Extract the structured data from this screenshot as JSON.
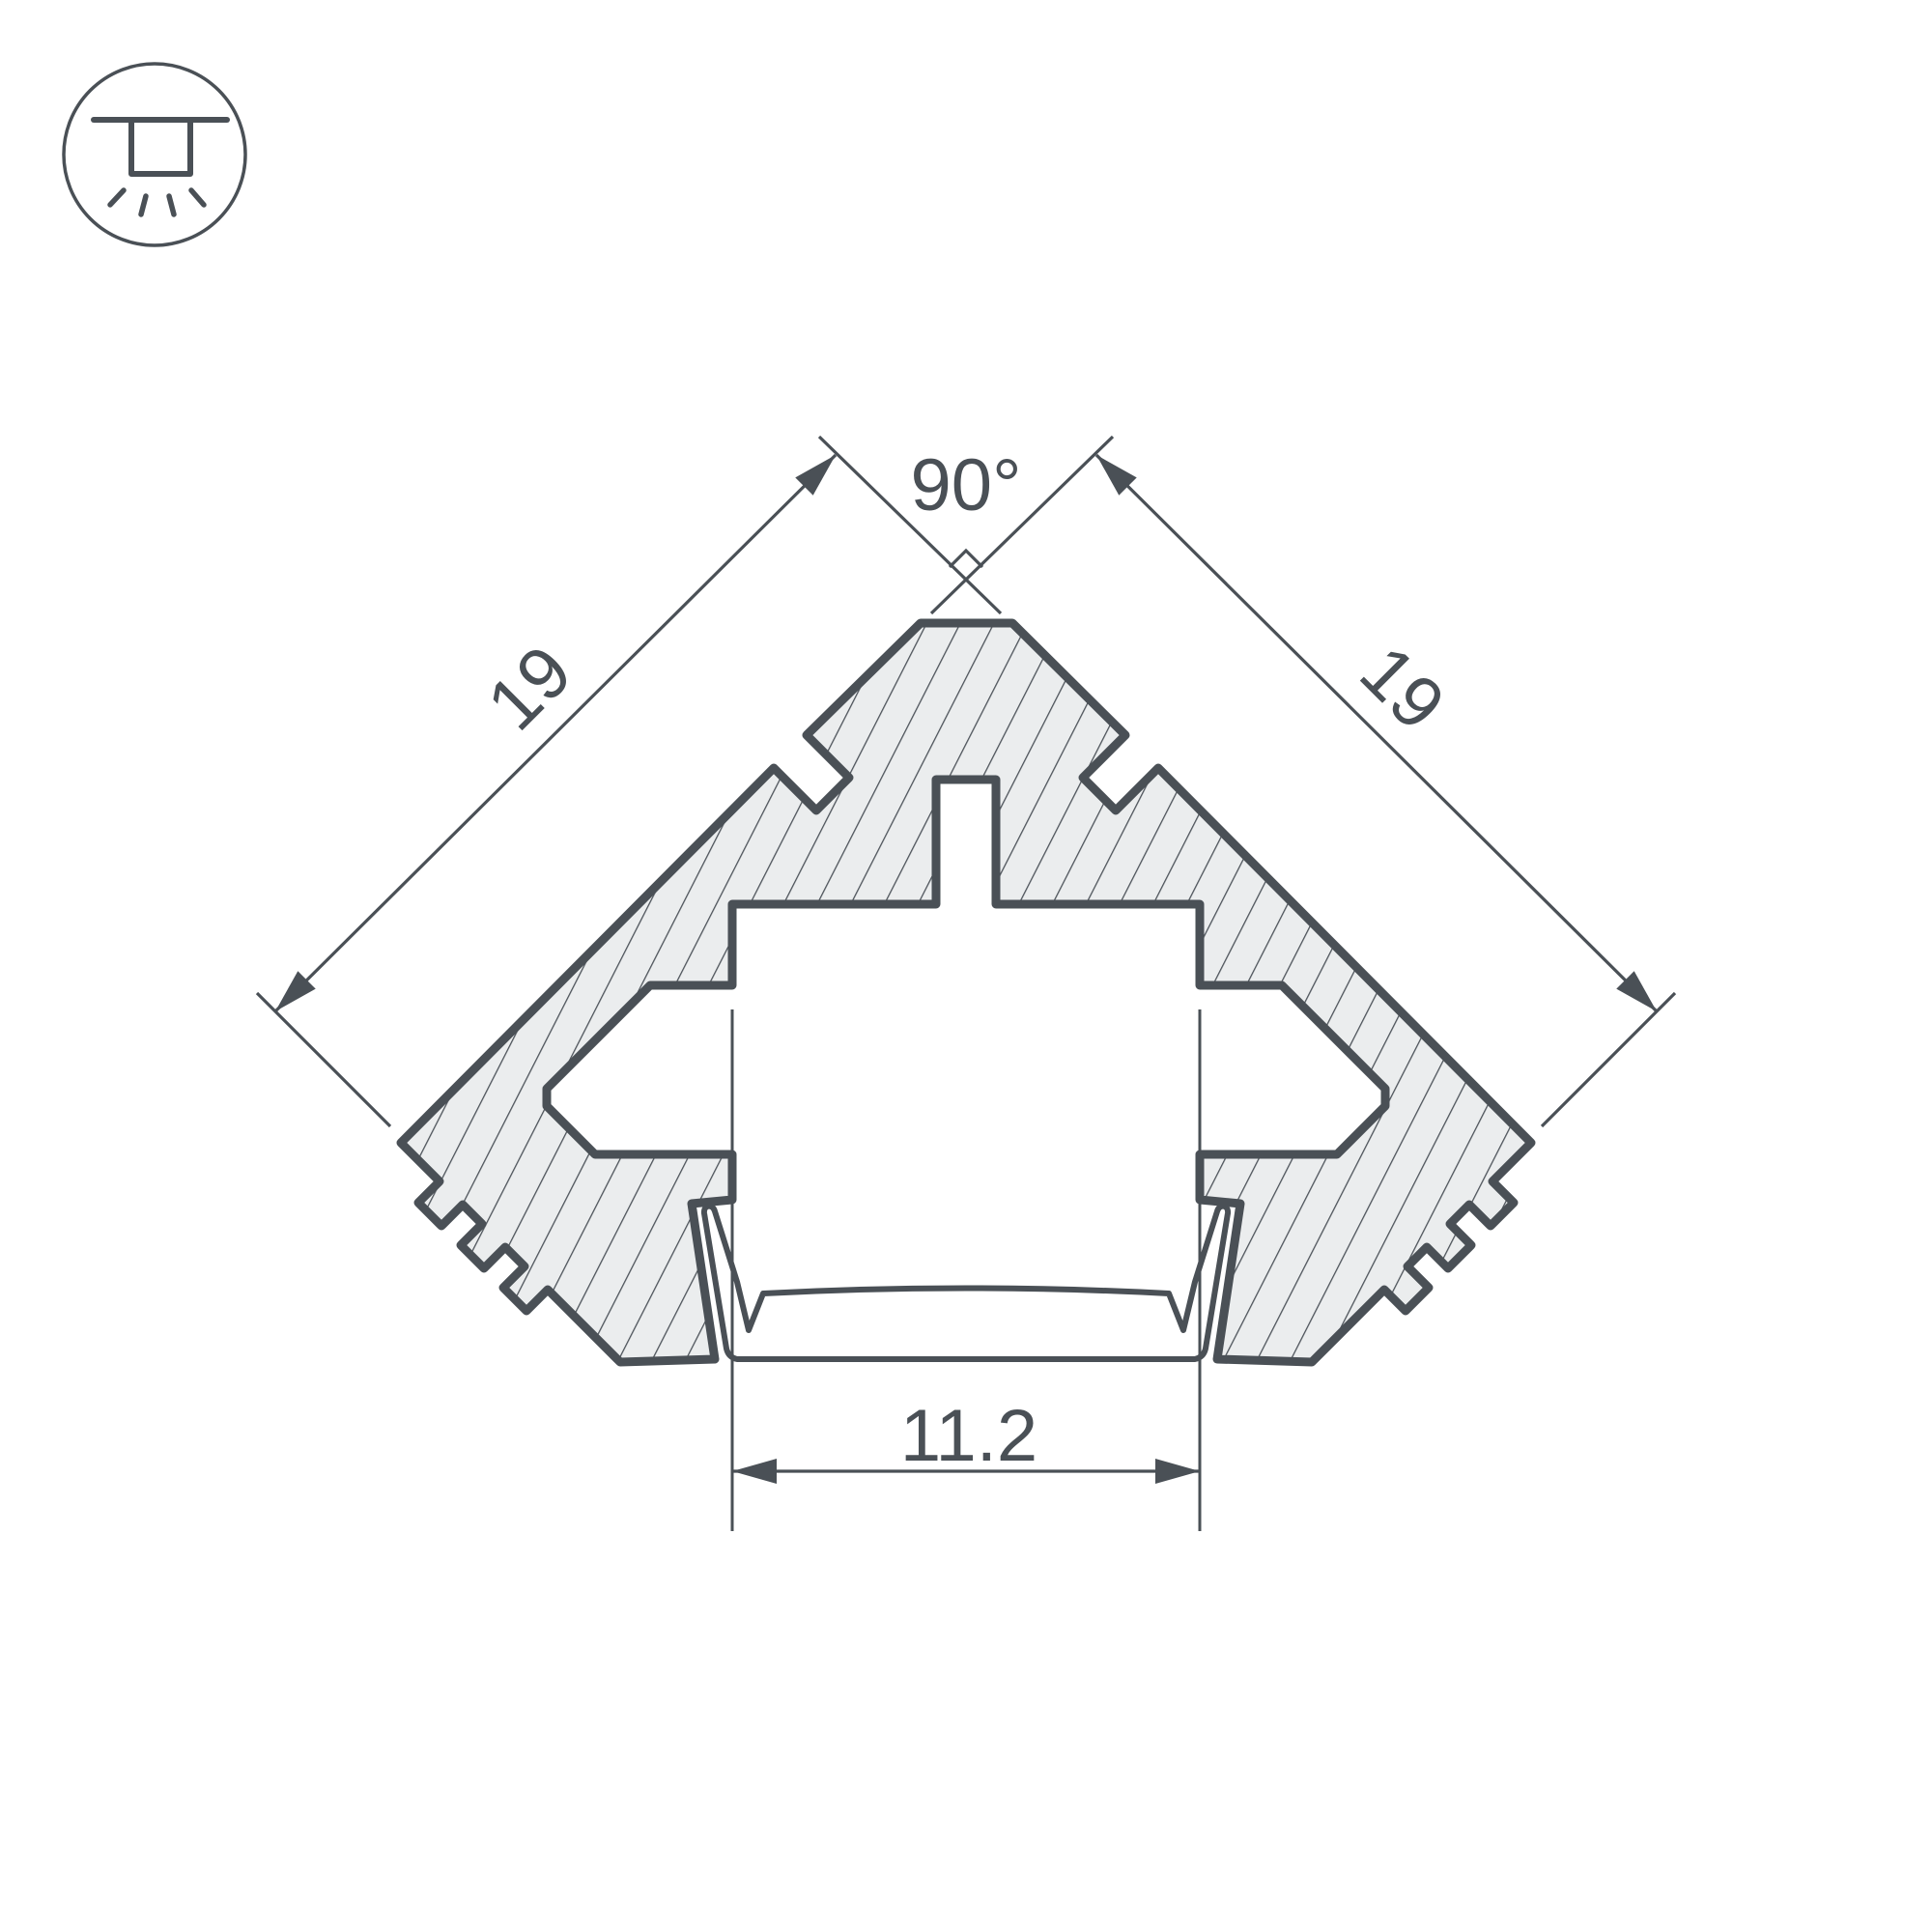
{
  "icon": {
    "name": "recessed-ceiling-light-icon",
    "description": "circle badge with recessed downlight glyph and light rays"
  },
  "dimensions": {
    "angle_label": "90°",
    "left_side_label": "19",
    "right_side_label": "19",
    "bottom_width_label": "11.2"
  },
  "colors": {
    "line": "#4a5056",
    "hatch_fill": "#ebedee",
    "background": "#ffffff"
  }
}
